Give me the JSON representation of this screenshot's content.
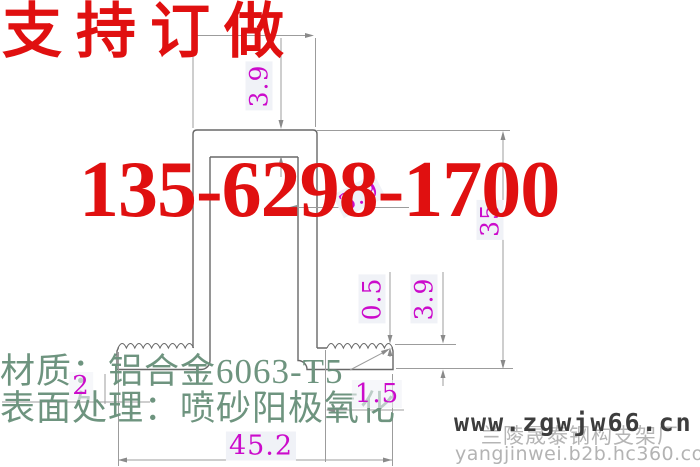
{
  "banner": {
    "custom_order_text": "支持订做",
    "phone": "135-6298-1700"
  },
  "drawing": {
    "dimensions": {
      "top_thickness": "3.9",
      "wall_thickness": "3.9",
      "overall_height": "35",
      "tooth_depth": "0.5",
      "foot_height": "3.9",
      "foot_offset": "1.5",
      "foot_lip": "2",
      "overall_width": "45.2"
    }
  },
  "specs": {
    "material": "材质：铝合金6063-T5",
    "surface_finish": "表面处理：喷砂阳极氧化"
  },
  "watermark": {
    "website": "www.zgwjw66.cn",
    "company": "兰陵晟泰钢构支架厂",
    "store_url": "yangjinwei.b2b.hc360.com"
  },
  "colors": {
    "banner_red": "#e01010",
    "dimension_magenta": "#cb0bcb",
    "spec_green": "#6e947f",
    "drawing_line_gray": "#9c9c9c",
    "watermark_dark": "#3d3d3d",
    "watermark_light": "#b5b5b5"
  }
}
